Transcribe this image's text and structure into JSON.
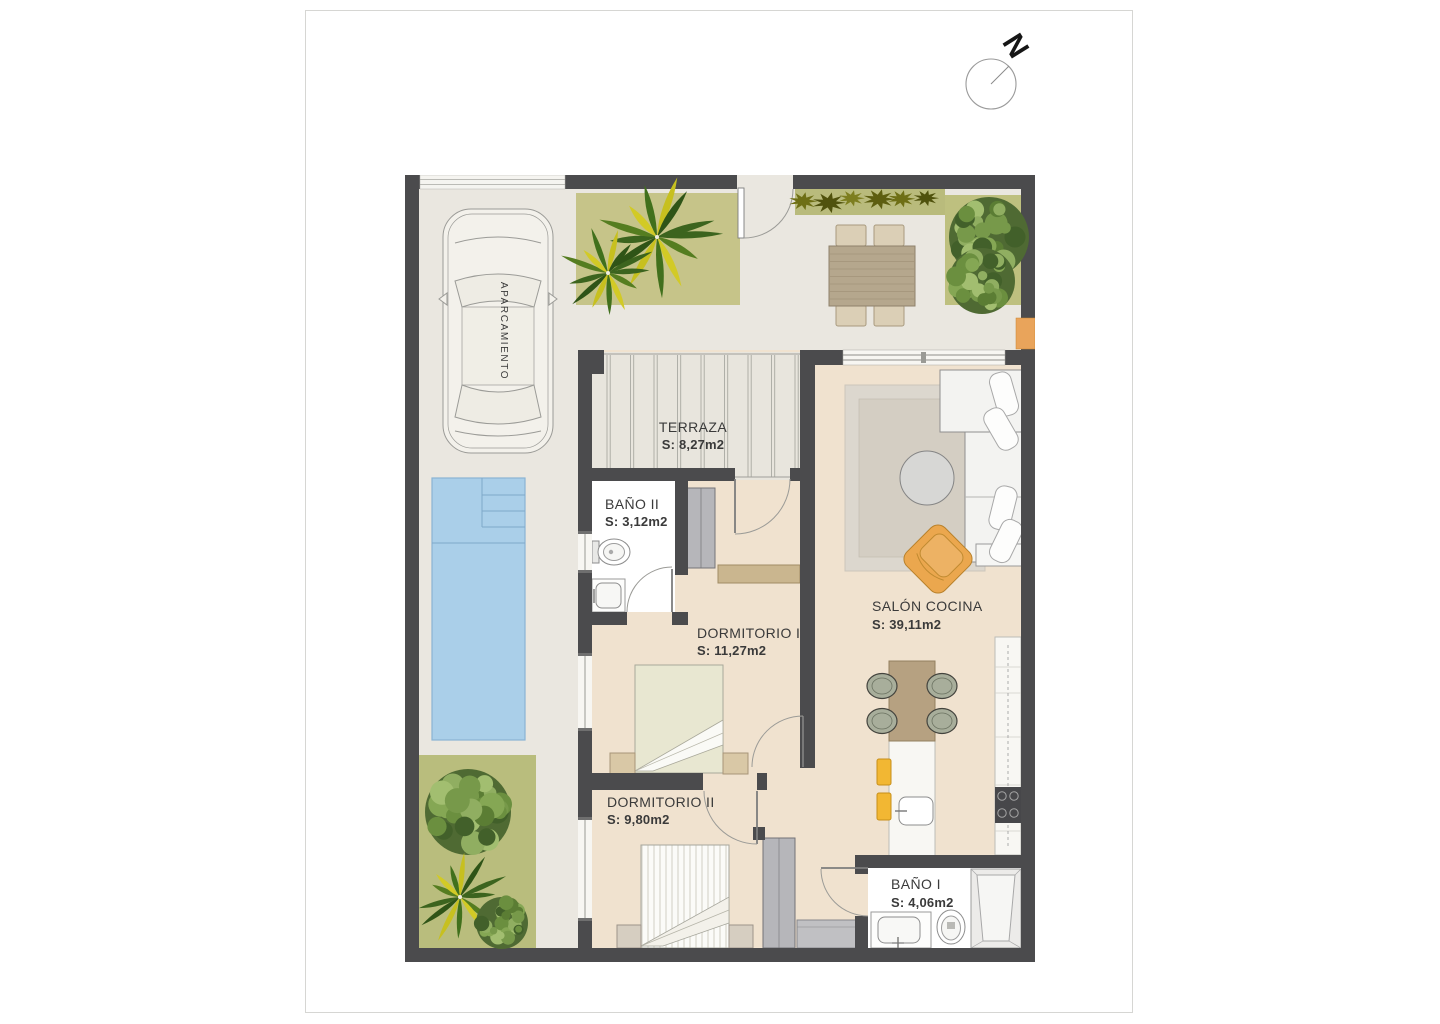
{
  "compass": {
    "label": "N"
  },
  "rooms": {
    "terraza": {
      "name": "TERRAZA",
      "area": "S: 8,27m2"
    },
    "bano2": {
      "name": "BAÑO II",
      "area": "S: 3,12m2"
    },
    "dorm1": {
      "name": "DORMITORIO I",
      "area": "S: 11,27m2"
    },
    "salon": {
      "name": "SALÓN COCINA",
      "area": "S: 39,11m2"
    },
    "dorm2": {
      "name": "DORMITORIO II",
      "area": "S: 9,80m2"
    },
    "bano1": {
      "name": "BAÑO I",
      "area": "S: 4,06m2"
    },
    "parking": {
      "name": "APARCAMIENTO"
    }
  },
  "colors": {
    "wall": "#4b4b4d",
    "outdoor_ground": "#eae7e0",
    "interior_floor": "#f0e2cf",
    "terrace_floor": "#e8e5dd",
    "bathroom_floor": "#ffffff",
    "pool_water": "#aacfe9",
    "lawn_green": "#c6c489",
    "plant_green": "#54731f",
    "palm_yellow": "#d2ca26",
    "accent_orange": "#e9a45b",
    "stool_yellow": "#f2b733",
    "wood_brown": "#b6a181",
    "label_text": "#3a3a3a"
  }
}
